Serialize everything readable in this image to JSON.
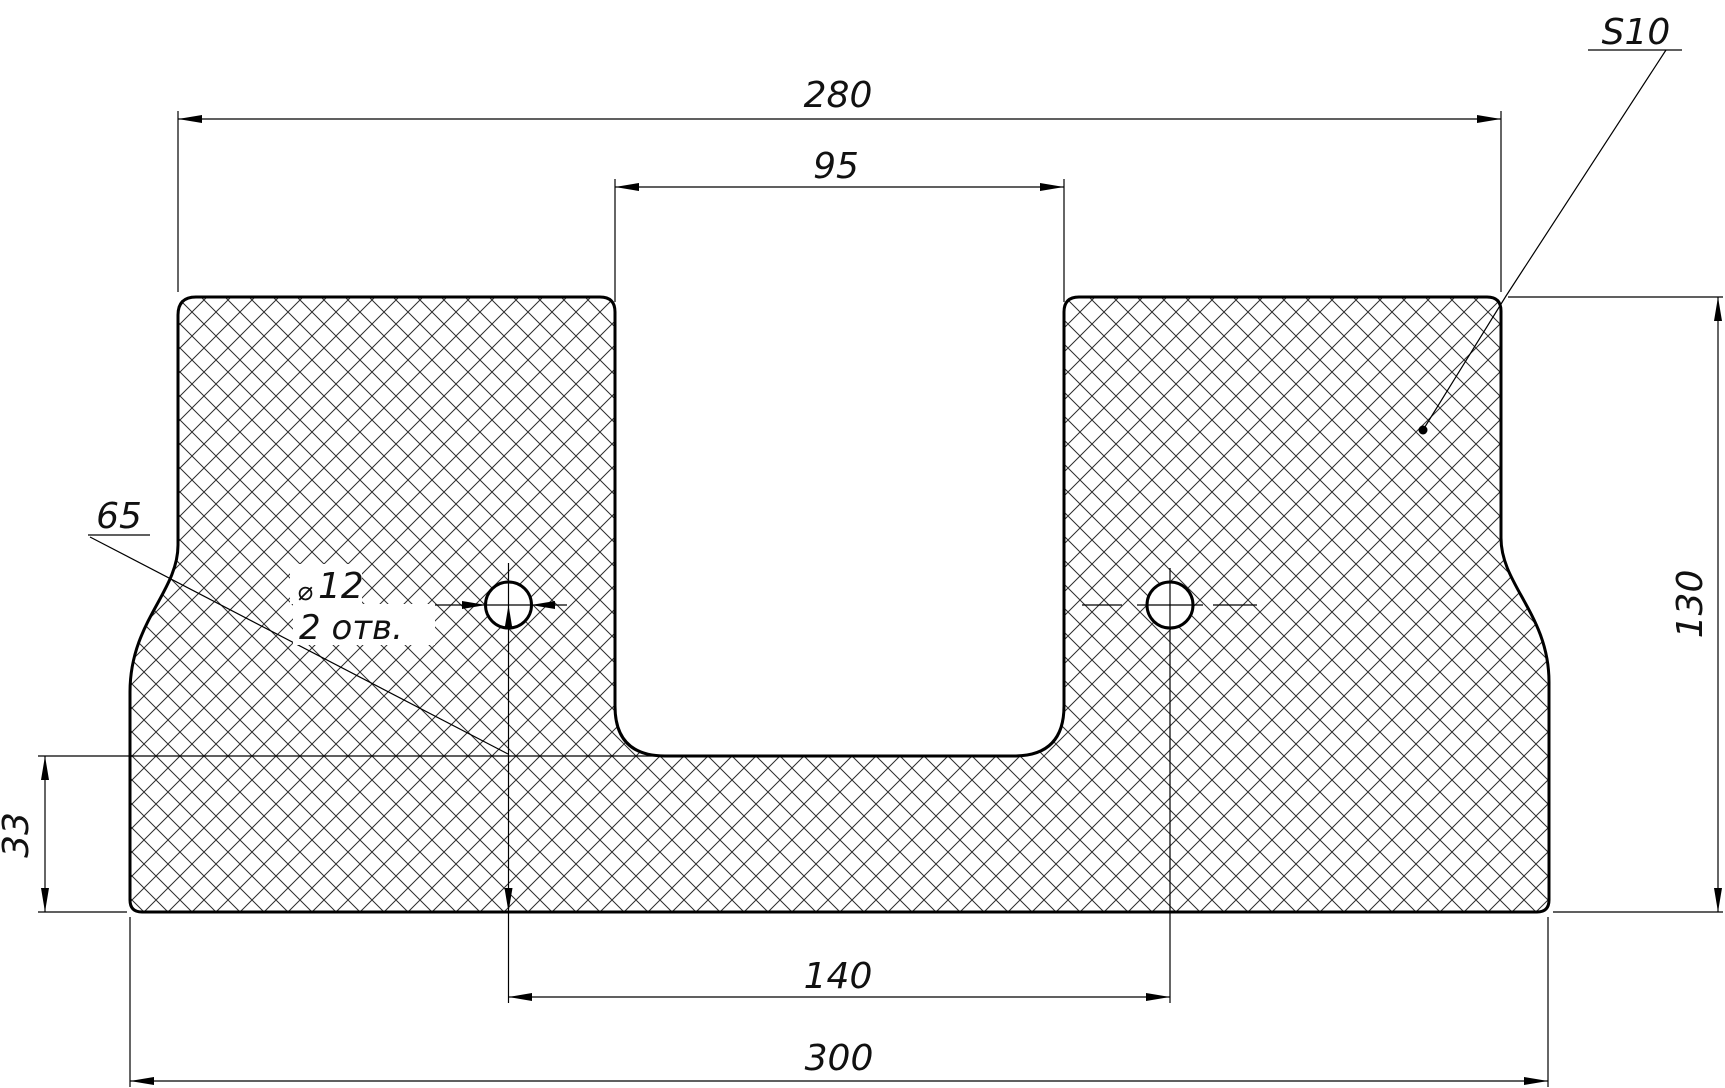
{
  "drawing": {
    "type": "technical-cross-section",
    "background_color": "#ffffff",
    "line_color": "#000000",
    "dims": {
      "top_width": "280",
      "channel_width": "95",
      "hole_spacing": "140",
      "bottom_width": "300",
      "overall_height": "130",
      "base_height": "33",
      "hole_center_height": "65"
    },
    "notes": {
      "thickness": "S10",
      "hole_dia_symbol": "⌀",
      "hole_dia_value": "12",
      "hole_count": "2 отв."
    }
  }
}
